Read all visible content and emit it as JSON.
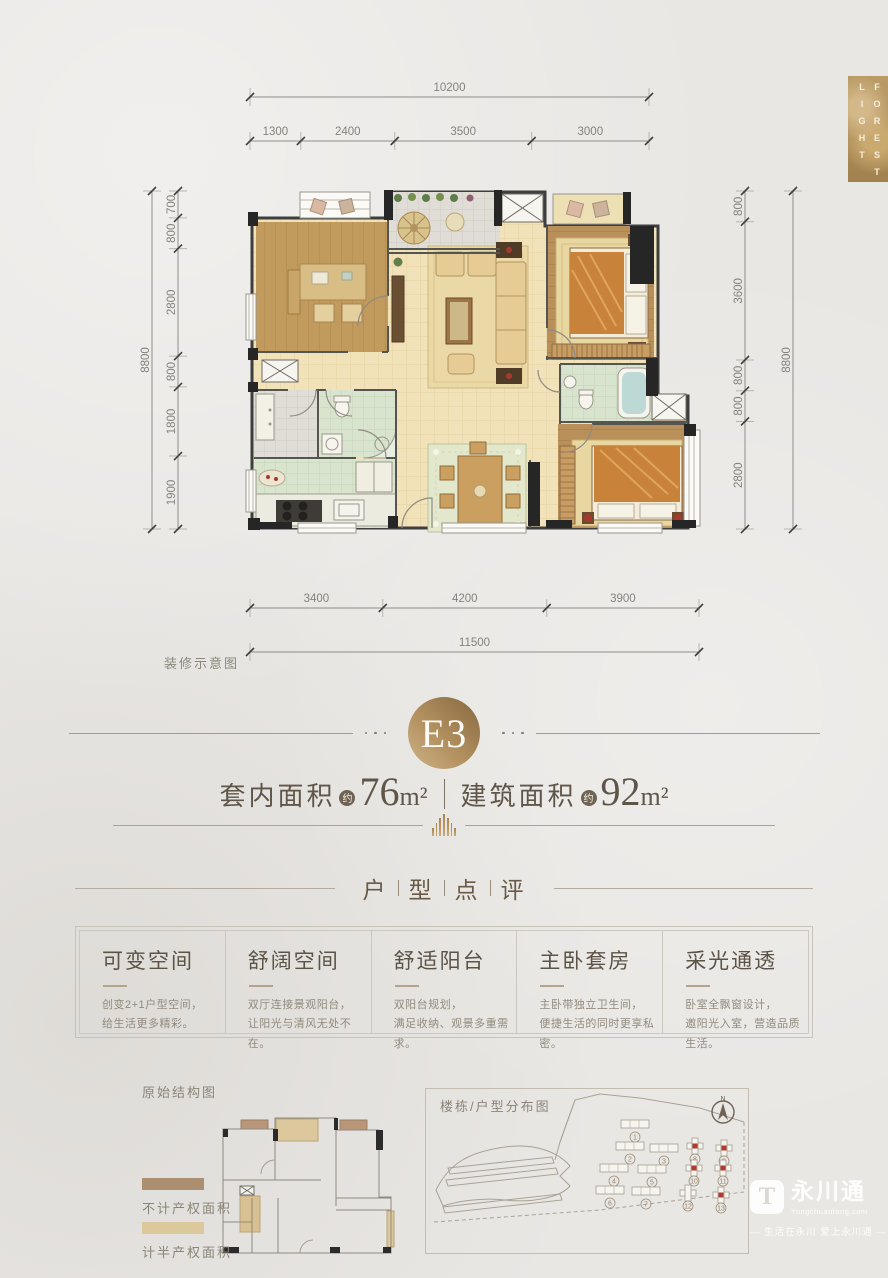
{
  "banner": {
    "word1": "LIGHT",
    "word2": "FOREST"
  },
  "floor_plan": {
    "caption": "装修示意图",
    "dimensions": {
      "top_total": "10200",
      "top_segments": [
        "1300",
        "2400",
        "3500",
        "3000"
      ],
      "left_total": "8800",
      "left_segments": [
        "700",
        "800",
        "2800",
        "800",
        "1800",
        "1900"
      ],
      "right_total": "8800",
      "right_segments": [
        "800",
        "3600",
        "800",
        "800",
        "2800"
      ],
      "bottom_total": "11500",
      "bottom_segments": [
        "3400",
        "4200",
        "3900"
      ]
    }
  },
  "unit": {
    "badge": "E3",
    "areas": [
      {
        "label": "套内面积",
        "approx": "约",
        "value": "76",
        "unit": "m²"
      },
      {
        "label": "建筑面积",
        "approx": "约",
        "value": "92",
        "unit": "m²"
      }
    ]
  },
  "review": {
    "title_chars": [
      "户",
      "型",
      "点",
      "评"
    ],
    "cards": [
      {
        "title": "可变空间",
        "line1": "创变2+1户型空间，",
        "line2": "给生活更多精彩。"
      },
      {
        "title": "舒阔空间",
        "line1": "双厅连接景观阳台，",
        "line2": "让阳光与清风无处不在。"
      },
      {
        "title": "舒适阳台",
        "line1": "双阳台规划，",
        "line2": "满足收纳、观景多重需求。"
      },
      {
        "title": "主卧套房",
        "line1": "主卧带独立卫生间，",
        "line2": "便捷生活的同时更享私密。"
      },
      {
        "title": "采光通透",
        "line1": "卧室全飘窗设计，",
        "line2": "邀阳光入室，营造品质生活。"
      }
    ]
  },
  "footer": {
    "structure_title": "原始结构图",
    "legend": [
      {
        "label": "不计产权面积",
        "color": "#ac8f71"
      },
      {
        "label": "计半产权面积",
        "color": "#dcc99b"
      }
    ],
    "site_plan": {
      "title": "楼栋/户型分布图",
      "compass": "N",
      "buildings": [
        {
          "no": "1",
          "x": 635,
          "y": 1124,
          "red": false,
          "shape": "bar"
        },
        {
          "no": "2",
          "x": 630,
          "y": 1146,
          "red": false,
          "shape": "bar"
        },
        {
          "no": "3",
          "x": 664,
          "y": 1148,
          "red": false,
          "shape": "bar"
        },
        {
          "no": "8",
          "x": 695,
          "y": 1146,
          "red": true,
          "shape": "cross"
        },
        {
          "no": "9",
          "x": 724,
          "y": 1148,
          "red": true,
          "shape": "cross"
        },
        {
          "no": "4",
          "x": 614,
          "y": 1168,
          "red": false,
          "shape": "bar"
        },
        {
          "no": "5",
          "x": 652,
          "y": 1169,
          "red": false,
          "shape": "bar"
        },
        {
          "no": "10",
          "x": 694,
          "y": 1168,
          "red": true,
          "shape": "cross"
        },
        {
          "no": "11",
          "x": 723,
          "y": 1168,
          "red": true,
          "shape": "cross"
        },
        {
          "no": "6",
          "x": 610,
          "y": 1190,
          "red": false,
          "shape": "bar"
        },
        {
          "no": "7",
          "x": 646,
          "y": 1191,
          "red": false,
          "shape": "bar"
        },
        {
          "no": "12",
          "x": 688,
          "y": 1193,
          "red": false,
          "shape": "cross"
        },
        {
          "no": "13",
          "x": 721,
          "y": 1195,
          "red": true,
          "shape": "cross"
        }
      ]
    }
  },
  "logo": {
    "icon_letter": "T",
    "name": "永川通",
    "site": "Yongchuantong.com",
    "tagline": "— 生活在永川 爱上永川通 —"
  },
  "colors": {
    "gold": "#b3935f",
    "gold_dark": "#8e714c",
    "title_brown": "#5f5649",
    "body_gray": "#8f877c",
    "wall": "#3a3a3a",
    "wood": "#bf9658",
    "cream_floor": "#f1e2ba",
    "green_tile": "#d7e3cd",
    "bed_orange": "#c8823a",
    "red_marker": "#b03a30",
    "page_bg": "#e9e7e4"
  }
}
